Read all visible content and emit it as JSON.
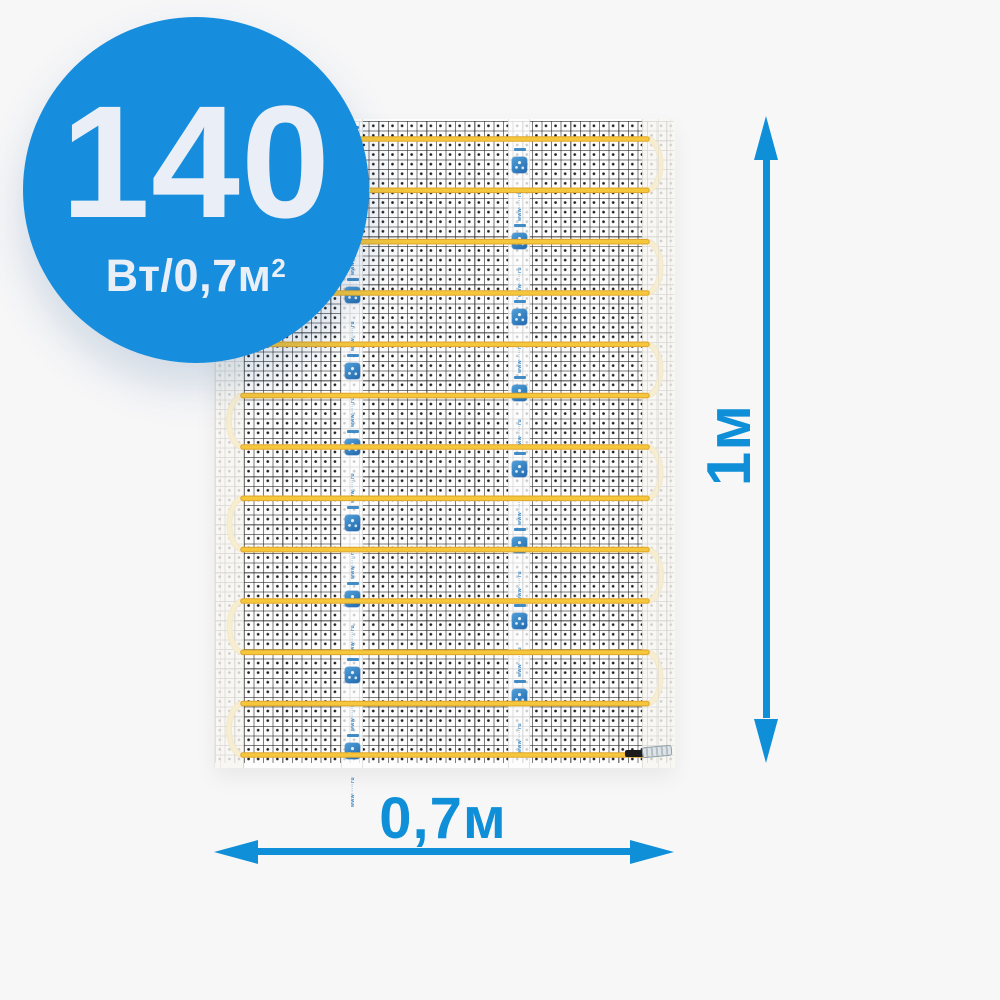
{
  "badge": {
    "power_value": "140",
    "power_unit": "Вт/0,7м",
    "power_unit_sup": "2"
  },
  "dimensions": {
    "height_label": "1м",
    "width_label": "0,7м"
  },
  "mat": {
    "heating_rows": 13,
    "tape_count": 2,
    "tape_micro_text": "www·····ru",
    "tape_mark_period_px": 76,
    "tape_offsets_px": [
      7,
      29
    ]
  },
  "icons": {
    "brand_logo": "brand-logo-icon",
    "arrows": [
      "arrow-up-icon",
      "arrow-down-icon",
      "arrow-left-icon",
      "arrow-right-icon"
    ]
  },
  "colors": {
    "background": "#f7f7f8",
    "badge_blue": "#168ddd",
    "badge_text": "#e9eef7",
    "dimension_blue": "#0f8fd8",
    "cable_yellow": "#f6c63b",
    "cable_edge": "#e0a92f",
    "tape_mark_blue": "#2e7fc2",
    "mesh_dark": "#1c1c1c"
  }
}
